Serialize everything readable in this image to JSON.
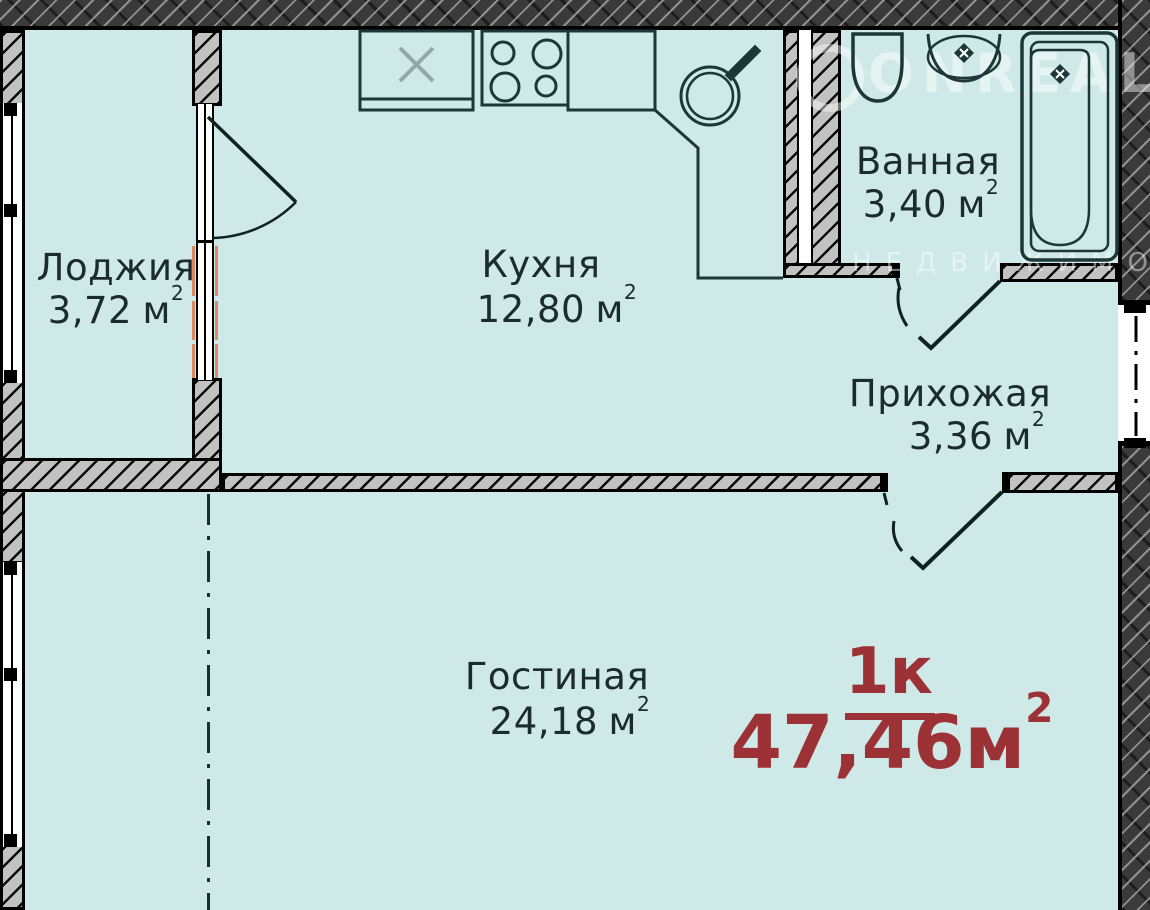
{
  "rooms": [
    {
      "id": "loggia",
      "name": "Лоджия",
      "area": "3,72",
      "unit": "м",
      "sup": "2"
    },
    {
      "id": "kitchen",
      "name": "Кухня",
      "area": "12,80",
      "unit": "м",
      "sup": "2"
    },
    {
      "id": "bathroom",
      "name": "Ванная",
      "area": "3,40",
      "unit": "м",
      "sup": "2"
    },
    {
      "id": "hallway",
      "name": "Прихожая",
      "area": "3,36",
      "unit": "м",
      "sup": "2"
    },
    {
      "id": "living",
      "name": "Гостиная",
      "area": "24,18",
      "unit": "м",
      "sup": "2"
    }
  ],
  "summary": {
    "type_label": "1к",
    "area_value": "47,46",
    "unit": "м",
    "sup": "2"
  },
  "watermark": {
    "brand": "ONREAL",
    "line2": "НЕДВИЖИМО"
  },
  "colors": {
    "floor": "#cfe9e8",
    "wall_dark": "#3a3a3a",
    "wall_light": "#c2c2c2",
    "line": "#1d3737",
    "red": "#9c3136",
    "orange": "#d98b5f",
    "wm": "rgba(255,255,255,0.45)"
  }
}
